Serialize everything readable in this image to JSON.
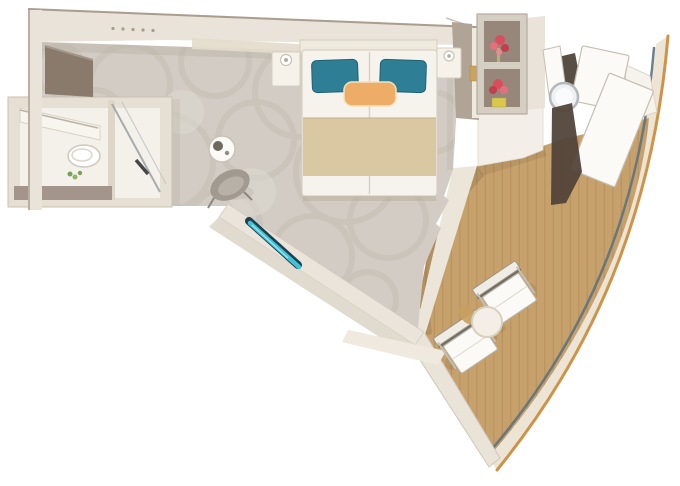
{
  "scene": {
    "kind": "cruise-ship-stateroom-floor-plan",
    "view": "top-down-3d-render"
  },
  "palette": {
    "background": "#ffffff",
    "wall": "#e9e3da",
    "wall_edge": "#a99d8e",
    "wall_shadow": "#b3a897",
    "soffit": "#e3dbcb",
    "closet_taupe": "#8a7a6b",
    "wardrobe_taupe": "#b0a496",
    "carpet": "#d2ccc4",
    "carpet_pattern": "#c1bab0",
    "carpet_pattern_light": "#dedad2",
    "bathroom_floor": "#f4f1ea",
    "bath_mat": "#a3958c",
    "glass_line": "#9aa1a3",
    "deck_wood": "#c7a16b",
    "deck_plank": "#a9814e",
    "hull_outline": "#cf9347",
    "hull_band": "#ece4d4",
    "railing": "#5d7181",
    "bed_linen": "#f6f3ec",
    "bed_runner": "#d9c8a2",
    "pillow_teal": "#2e7e95",
    "pillow_accent": "#eead66",
    "bench_teal": "#41c3d6",
    "bench_teal_dark": "#1d4152",
    "flower_red": "#d84f5b",
    "flower_pink": "#e4707d",
    "flower_yellow": "#d9c84e",
    "shelf_back": "#96877a",
    "chair_gray": "#a09a90",
    "furniture_white": "#fbfaf6",
    "furniture_outline": "#c5beb2",
    "dark_wedge": "#52453a",
    "metal": "#b4b8bc"
  },
  "objects": {
    "bathroom": {
      "fixtures": [
        "toilet",
        "vanity-counter",
        "mirror",
        "glass-shower",
        "bath-mat",
        "plant"
      ]
    },
    "bedroom": {
      "bed": {
        "style": "double",
        "teal_pillows": 2,
        "accent_pillows": 1
      },
      "nightstands": 2,
      "wardrobe": 1,
      "shelf_unit": {
        "compartments": 2,
        "decor": "red-flowers"
      },
      "side_table": 1,
      "armchair": 1,
      "accent_bench": 1,
      "ceiling_lights": 5
    },
    "balcony": {
      "deck": "teak-planks",
      "deck_chairs": 2,
      "round_table": 1,
      "loungers": 2,
      "lounger_table": 1
    },
    "ship": {
      "hull_curve": true,
      "railing": true
    }
  }
}
